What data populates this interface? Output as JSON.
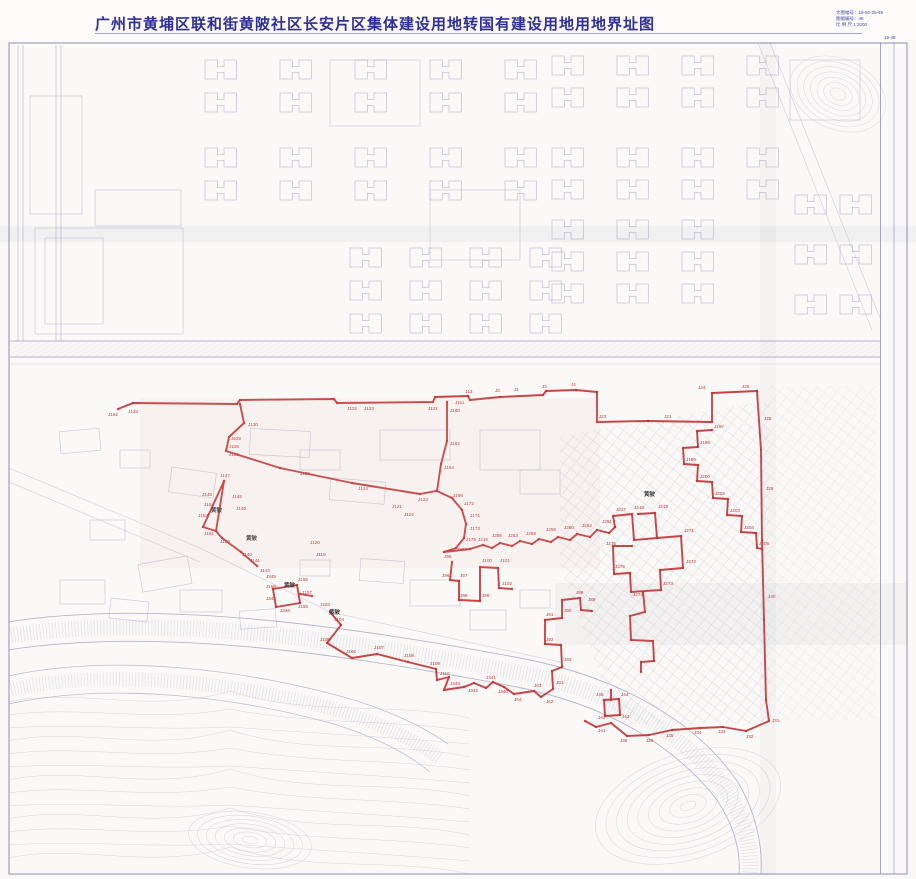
{
  "title": "广州市黄埔区联和街黄陂社区长安片区集体建设用地转国有建设用地用地界址图",
  "info_box": {
    "line1": "大图幅号：19-50-25-48",
    "line2": "图幅编号：48",
    "line3": "比 例 尺  1:2000"
  },
  "sheet_label": "19-48",
  "colors": {
    "boundary": "#c23535",
    "base_line": "#a7a4c2",
    "title_blue": "#2f2f96",
    "frame": "#8e8eb0",
    "label_black": "#3b3b3b"
  },
  "boundary": {
    "paths": [
      "118,409 133,403 237,404 240,400 334,399 337,403 433,402 435,397 468,396 470,400 500,397 543,395 546,391 576,390 597,392 597,422 648,421 712,422 712,393 757,391",
      "757,391 761,450 762,540 764,620 766,700 769,721 746,731 723,727 700,728 672,730 649,735 627,736 611,723 596,727 585,721",
      "240,404 244,423 229,437 226,451 280,468 352,483 420,494 436,491",
      "447,402 447,441 441,464 437,491 452,498 462,510 466,524 464,538 456,548 444,552",
      "444,552 470,549 483,545 492,548 500,543 512,546 520,541 532,544 539,539 551,542 558,537 570,540 577,534 590,537 597,530 609,533 615,527",
      "615,527 613,516 632,514 634,540 657,538 655,513 638,514",
      "657,538 681,536 683,568 660,570 661,590 631,592 630,573 614,574 613,546 632,546",
      "643,592 645,612 630,616 631,640 653,641 654,661 641,662 641,672",
      "330,612 341,625 327,643 352,658 377,654 408,662 436,669 437,680 449,677 444,690 464,687 474,683 486,688 493,682 504,687 514,694 534,691 541,697 553,689 552,671 562,667",
      "562,667 561,645 545,644 545,620 562,618 562,600 580,598 581,610 592,611",
      "604,700 619,699 620,715 605,716 604,700",
      "611,690 611,700",
      "224,481 216,531 203,527 224,481",
      "216,531 222,538 241,552 257,566",
      "273,589 297,585 300,603 276,607 273,589",
      "300,594 312,596",
      "452,562 450,580 459,581 459,600 480,601 480,567 498,568 499,588 512,589",
      "712,430 697,431 698,447 683,448 684,464 698,465 697,481 712,482 713,498 728,499 727,515 742,516 741,532 756,533 757,548 762,549"
    ],
    "labels": [
      [
        108,
        416,
        "J152"
      ],
      [
        128,
        413,
        "J134"
      ],
      [
        347,
        410,
        "J132"
      ],
      [
        364,
        410,
        "J133"
      ],
      [
        428,
        410,
        "J131"
      ],
      [
        455,
        404,
        "J111"
      ],
      [
        465,
        393,
        "J13"
      ],
      [
        495,
        392,
        "J2"
      ],
      [
        514,
        391,
        "J1"
      ],
      [
        542,
        388,
        "J3"
      ],
      [
        571,
        386,
        "J4"
      ],
      [
        599,
        418,
        "J23"
      ],
      [
        664,
        418,
        "J21"
      ],
      [
        698,
        389,
        "J24"
      ],
      [
        742,
        388,
        "J26"
      ],
      [
        764,
        420,
        "J28"
      ],
      [
        248,
        426,
        "J130"
      ],
      [
        231,
        440,
        "J129"
      ],
      [
        229,
        448,
        "J128"
      ],
      [
        229,
        456,
        "J126"
      ],
      [
        300,
        475,
        "J125"
      ],
      [
        358,
        490,
        "J124"
      ],
      [
        418,
        501,
        "J123"
      ],
      [
        450,
        412,
        "J180"
      ],
      [
        450,
        445,
        "J182"
      ],
      [
        444,
        469,
        "J184"
      ],
      [
        453,
        497,
        "J169"
      ],
      [
        464,
        505,
        "J172"
      ],
      [
        470,
        517,
        "J171"
      ],
      [
        470,
        530,
        "J173"
      ],
      [
        466,
        541,
        "J175"
      ],
      [
        457,
        551,
        "J174"
      ],
      [
        478,
        541,
        "J216"
      ],
      [
        492,
        537,
        "J256"
      ],
      [
        508,
        537,
        "J263"
      ],
      [
        526,
        535,
        "J258"
      ],
      [
        546,
        531,
        "J259"
      ],
      [
        564,
        529,
        "J260"
      ],
      [
        582,
        527,
        "J262"
      ],
      [
        602,
        523,
        "J261"
      ],
      [
        616,
        511,
        "J217"
      ],
      [
        634,
        509,
        "J218"
      ],
      [
        658,
        508,
        "J219"
      ],
      [
        684,
        532,
        "J271"
      ],
      [
        686,
        563,
        "J272"
      ],
      [
        663,
        585,
        "J273"
      ],
      [
        633,
        596,
        "J274"
      ],
      [
        615,
        568,
        "J275"
      ],
      [
        606,
        545,
        "J276"
      ],
      [
        714,
        428,
        "J197"
      ],
      [
        700,
        444,
        "J198"
      ],
      [
        686,
        461,
        "J199"
      ],
      [
        700,
        478,
        "J200"
      ],
      [
        715,
        495,
        "J202"
      ],
      [
        730,
        512,
        "J203"
      ],
      [
        744,
        529,
        "J204"
      ],
      [
        759,
        545,
        "J205"
      ],
      [
        766,
        490,
        "J29"
      ],
      [
        768,
        598,
        "J30"
      ],
      [
        772,
        722,
        "J31"
      ],
      [
        746,
        738,
        "J32"
      ],
      [
        718,
        733,
        "J33"
      ],
      [
        694,
        734,
        "J34"
      ],
      [
        666,
        737,
        "J35"
      ],
      [
        646,
        742,
        "J36"
      ],
      [
        620,
        742,
        "J38"
      ],
      [
        598,
        732,
        "J41"
      ],
      [
        220,
        477,
        "J147"
      ],
      [
        202,
        496,
        "J146"
      ],
      [
        204,
        506,
        "J154"
      ],
      [
        198,
        517,
        "J153"
      ],
      [
        232,
        498,
        "J148"
      ],
      [
        236,
        510,
        "J149"
      ],
      [
        204,
        535,
        "J151"
      ],
      [
        220,
        543,
        "J150"
      ],
      [
        242,
        556,
        "J140"
      ],
      [
        250,
        562,
        "J141"
      ],
      [
        260,
        572,
        "J143"
      ],
      [
        266,
        578,
        "J345"
      ],
      [
        266,
        588,
        "J158"
      ],
      [
        298,
        581,
        "J156"
      ],
      [
        302,
        594,
        "J157"
      ],
      [
        266,
        600,
        "J344"
      ],
      [
        280,
        612,
        "J346"
      ],
      [
        298,
        608,
        "J155"
      ],
      [
        320,
        606,
        "J103"
      ],
      [
        334,
        621,
        "J104"
      ],
      [
        320,
        641,
        "J105"
      ],
      [
        346,
        653,
        "J106"
      ],
      [
        374,
        649,
        "J107"
      ],
      [
        404,
        657,
        "J108"
      ],
      [
        430,
        665,
        "J109"
      ],
      [
        440,
        675,
        "J110"
      ],
      [
        450,
        685,
        "J343"
      ],
      [
        468,
        692,
        "J342"
      ],
      [
        486,
        679,
        "J341"
      ],
      [
        498,
        693,
        "J340"
      ],
      [
        514,
        701,
        "J64"
      ],
      [
        534,
        687,
        "J63"
      ],
      [
        546,
        703,
        "J62"
      ],
      [
        556,
        684,
        "J61"
      ],
      [
        546,
        616,
        "J91"
      ],
      [
        564,
        612,
        "J90"
      ],
      [
        546,
        641,
        "J92"
      ],
      [
        564,
        661,
        "J93"
      ],
      [
        576,
        594,
        "J88"
      ],
      [
        588,
        601,
        "J89"
      ],
      [
        444,
        558,
        "J95"
      ],
      [
        442,
        577,
        "J96"
      ],
      [
        460,
        577,
        "J97"
      ],
      [
        460,
        597,
        "J98"
      ],
      [
        482,
        597,
        "J99"
      ],
      [
        482,
        562,
        "J100"
      ],
      [
        500,
        562,
        "J101"
      ],
      [
        502,
        585,
        "J102"
      ],
      [
        596,
        696,
        "J45"
      ],
      [
        621,
        696,
        "J44"
      ],
      [
        622,
        718,
        "J43"
      ],
      [
        598,
        719,
        "J42"
      ],
      [
        404,
        516,
        "J122"
      ],
      [
        392,
        508,
        "J121"
      ],
      [
        310,
        544,
        "J120"
      ],
      [
        316,
        556,
        "J119"
      ]
    ]
  },
  "place_labels": [
    [
      211,
      512,
      "黄陂"
    ],
    [
      246,
      540,
      "黄陂"
    ],
    [
      284,
      587,
      "黄陂"
    ],
    [
      329,
      614,
      "黄陂"
    ],
    [
      644,
      496,
      "黄陂"
    ]
  ]
}
